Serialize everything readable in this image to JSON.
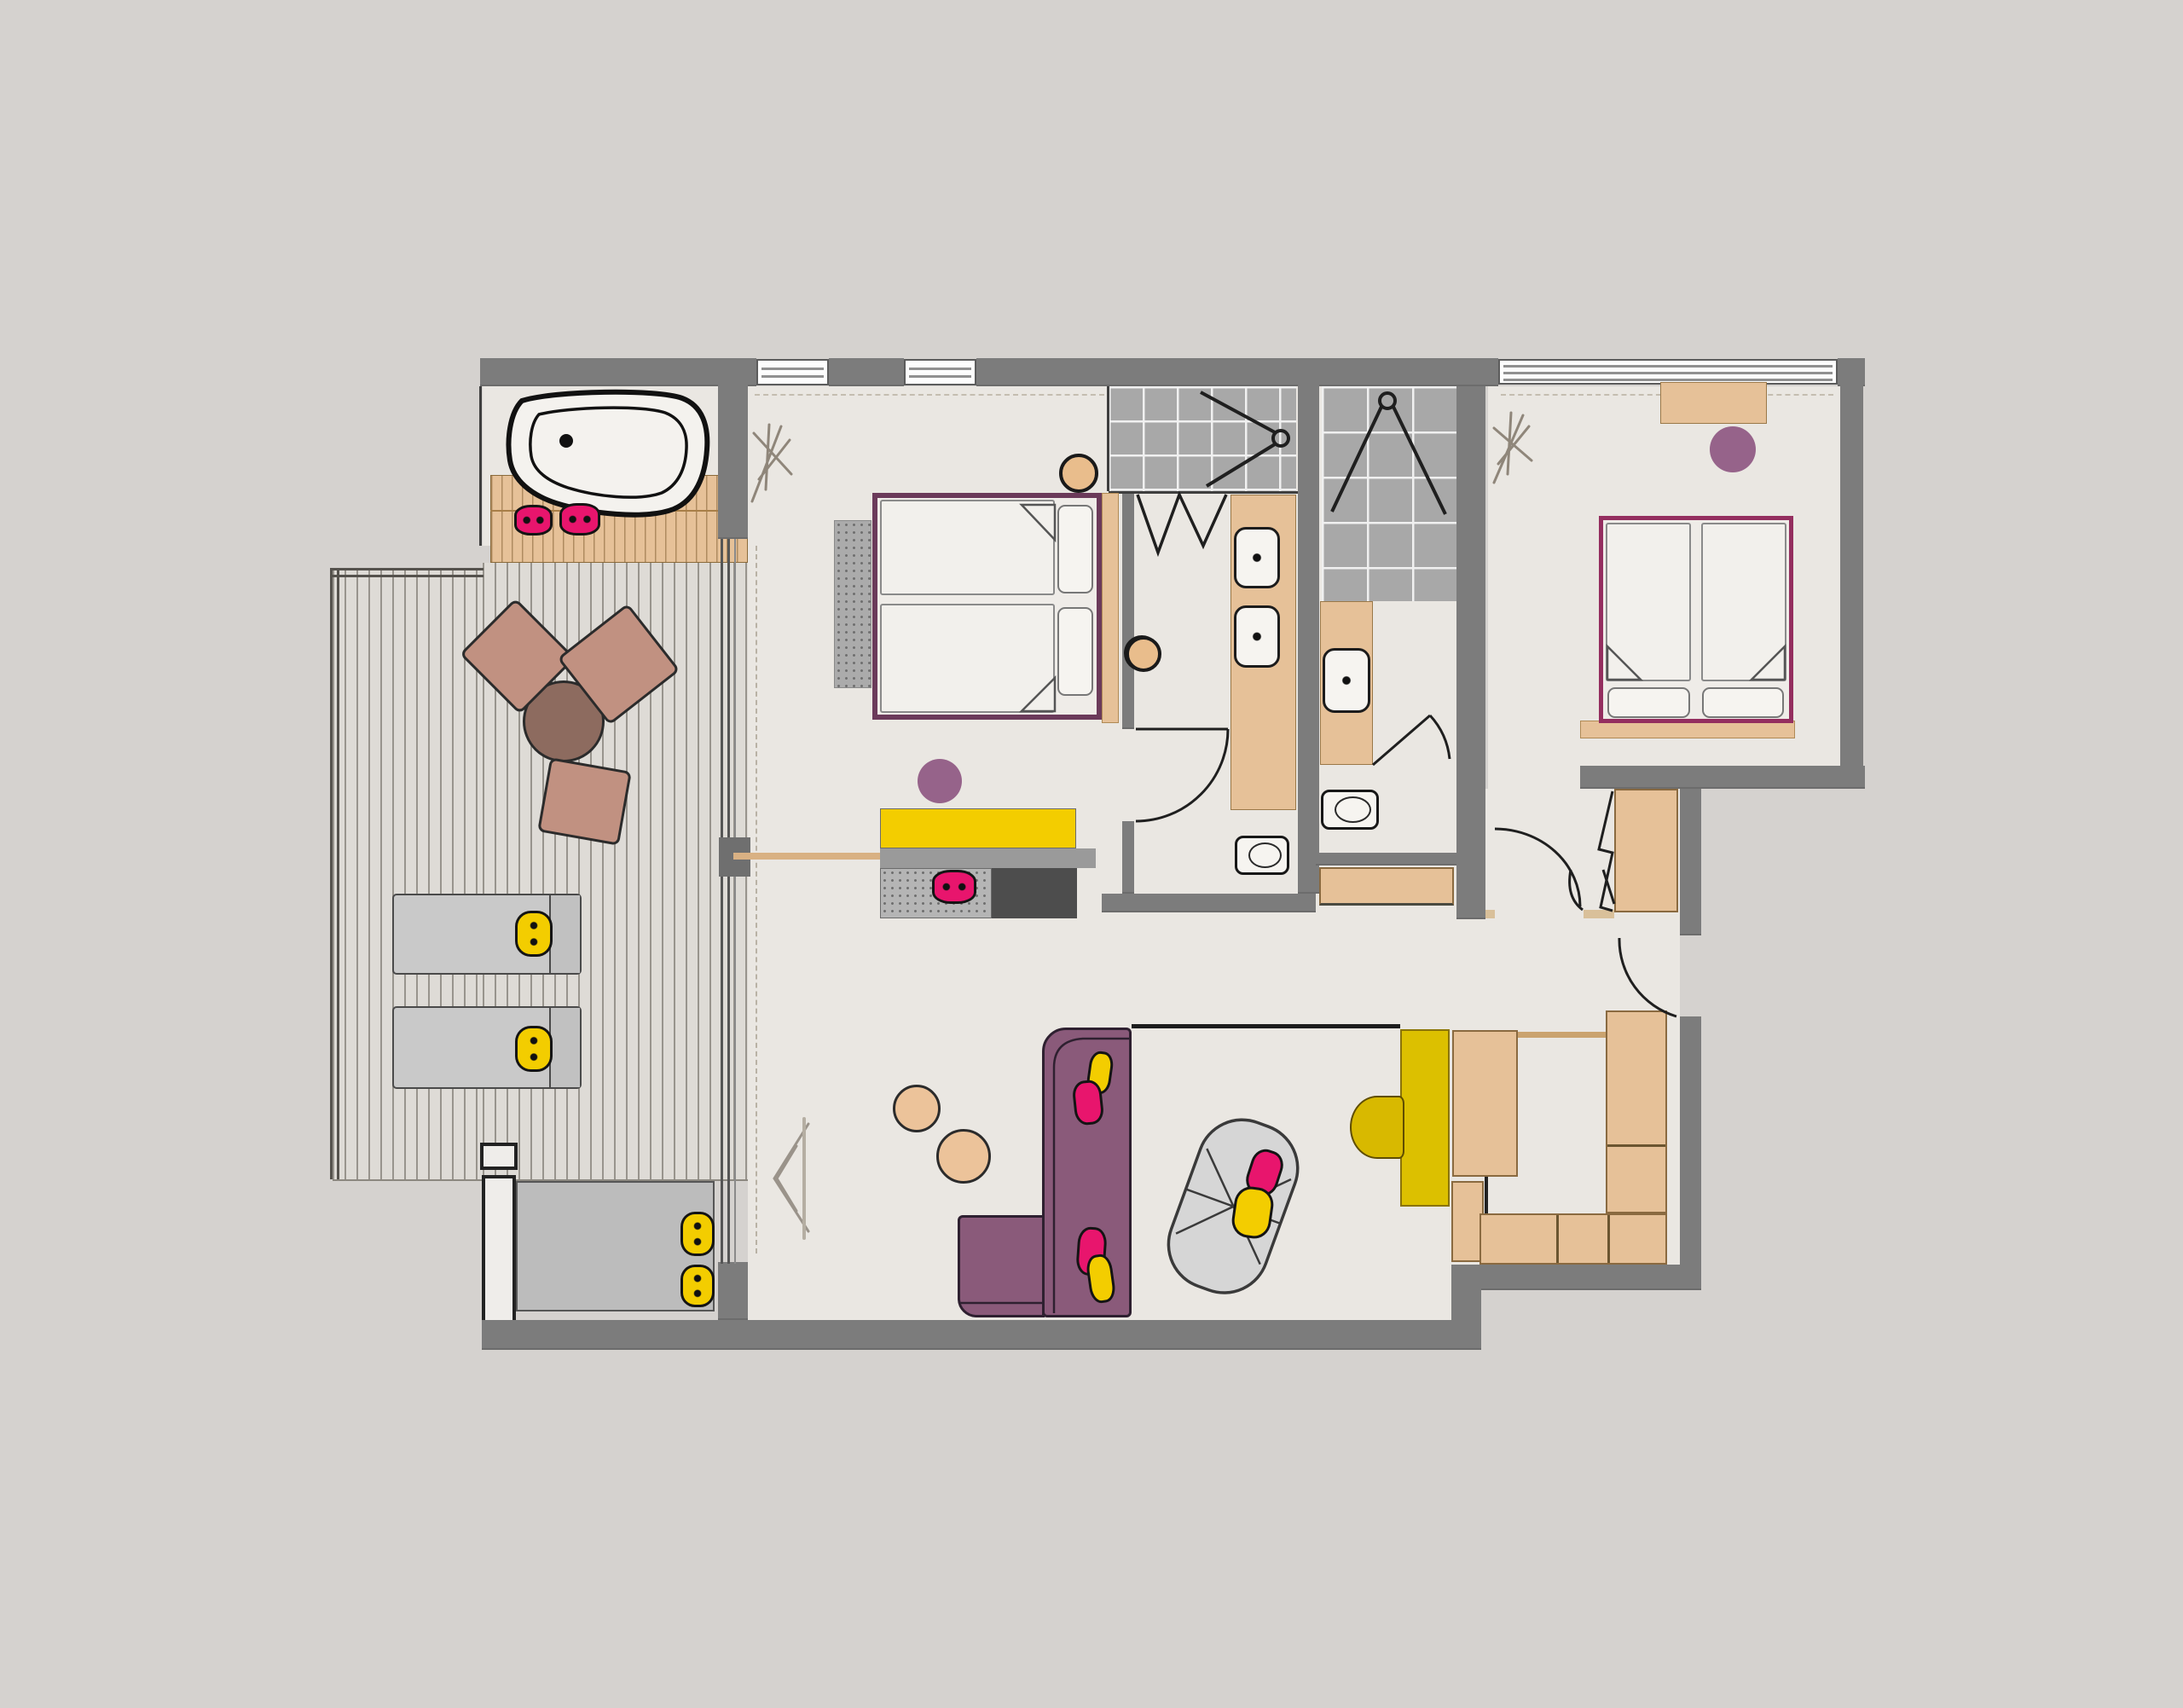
{
  "palette": {
    "bg": "#d5d2cf",
    "floor": "#eae7e2",
    "deck": "#dedbd6",
    "deck_line": "#98948d",
    "wall": "#7c7c7c",
    "tile": "#a8a8a8",
    "grout": "#f0f0f0",
    "wood": "#e6c198",
    "wood_dark": "#b98e58",
    "yellow": "#f3cd00",
    "gold": "#dcc000",
    "pink": "#e8156d",
    "sofa": "#8a5a7a",
    "sofa_edge": "#2e2030",
    "bed1": "#6b3a5a",
    "bed2": "#942e5f",
    "accent": "#96638a",
    "table": "#8d6b5f",
    "chair": "#c19181",
    "gray_light": "#c9c9c9",
    "gray_mid": "#9a9a9a",
    "gray_dark": "#4d4d4d",
    "rug": "#ababab",
    "ink": "#1f1f1f",
    "sketch": "#8f867a"
  },
  "plan": {
    "type": "hotel-suite-floor-plan",
    "rooms": [
      {
        "name": "balcony"
      },
      {
        "name": "bath-niche"
      },
      {
        "name": "living-bedroom"
      },
      {
        "name": "bathroom-1"
      },
      {
        "name": "bathroom-2"
      },
      {
        "name": "bedroom-2"
      },
      {
        "name": "hall"
      },
      {
        "name": "dressing-study"
      }
    ],
    "furniture": [
      {
        "name": "bathtub",
        "color": "white"
      },
      {
        "name": "bath-bench",
        "pillows": {
          "color": "pink",
          "count": 2
        }
      },
      {
        "name": "balcony-table",
        "color": "table",
        "chairs": 3
      },
      {
        "name": "sun-lounger",
        "count": 2,
        "pillows": {
          "color": "yellow",
          "count": 2
        }
      },
      {
        "name": "balcony-bench",
        "pillows": {
          "color": "yellow",
          "count": 2
        }
      },
      {
        "name": "double-bed",
        "frame": "bed1",
        "pillows": 2,
        "stools": 2
      },
      {
        "name": "bedside-rug",
        "color": "rug"
      },
      {
        "name": "media-sideboard",
        "color": "yellow"
      },
      {
        "name": "media-bench",
        "pillows": {
          "color": "pink",
          "count": 1
        }
      },
      {
        "name": "fireplace-cabinet",
        "color": "gray_dark"
      },
      {
        "name": "stool-purple",
        "count": 3,
        "color": "accent"
      },
      {
        "name": "corner-sofa",
        "color": "sofa",
        "pillows": {
          "pink": 2,
          "yellow": 2
        }
      },
      {
        "name": "pouf",
        "count": 2,
        "color": "chair"
      },
      {
        "name": "daybed",
        "pillows": {
          "pink": 1,
          "yellow": 1
        }
      },
      {
        "name": "desk",
        "color": "gold"
      },
      {
        "name": "desk-chair",
        "color": "gold"
      },
      {
        "name": "wardrobe-units",
        "count": 7,
        "color": "wood"
      },
      {
        "name": "twin-bed",
        "frame": "bed2",
        "pillows": 2
      },
      {
        "name": "bedroom2-sideboard",
        "color": "wood"
      },
      {
        "name": "vanity-double-sink",
        "sinks": 2
      },
      {
        "name": "vanity-single-sink",
        "sinks": 1
      },
      {
        "name": "toilet",
        "count": 2
      },
      {
        "name": "shower",
        "count": 2
      },
      {
        "name": "door-swing",
        "count": 5
      },
      {
        "name": "window",
        "count": 3
      },
      {
        "name": "curtain-sketch",
        "count": 3
      }
    ]
  }
}
